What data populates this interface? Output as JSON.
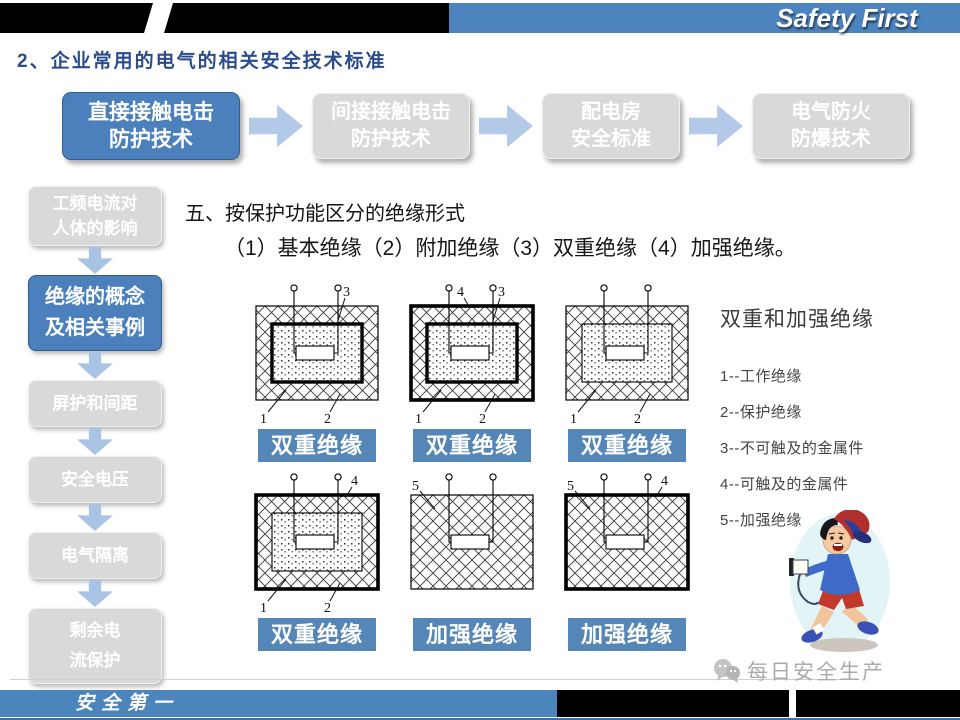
{
  "header": {
    "brand": "Safety First",
    "section_title": "2、企业常用的电气的相关安全技术标准"
  },
  "flow": {
    "boxes": [
      {
        "label": "直接接触电击\n防护技术",
        "active": true
      },
      {
        "label": "间接接触电击\n防护技术",
        "active": false
      },
      {
        "label": "配电房\n安全标准",
        "active": false
      },
      {
        "label": "电气防火\n防爆技术",
        "active": false
      }
    ]
  },
  "sidebar": {
    "items": [
      {
        "label": "工频电流对\n人体的影响",
        "active": false
      },
      {
        "label": "绝缘的概念\n及相关事例",
        "active": true
      },
      {
        "label": "屏护和间距",
        "active": false
      },
      {
        "label": "安全电压",
        "active": false
      },
      {
        "label": "电气隔离",
        "active": false
      },
      {
        "label": "剩余电\n流保护",
        "active": false
      }
    ]
  },
  "main": {
    "heading": "五、按保护功能区分的绝缘形式",
    "subheading": "（1）基本绝缘（2）附加绝缘（3）双重绝缘（4）加强绝缘。"
  },
  "diagrams": [
    {
      "caption": "双重绝缘",
      "outer": "thin",
      "inner": "thick",
      "top_labels": [
        {
          "text": "3",
          "pos": "right-inner"
        }
      ],
      "bottom_labels": [
        "1",
        "2"
      ]
    },
    {
      "caption": "双重绝缘",
      "outer": "thick",
      "inner": "thick",
      "top_labels": [
        {
          "text": "4",
          "pos": "midleft"
        },
        {
          "text": "3",
          "pos": "right-inner"
        }
      ],
      "bottom_labels": [
        "1",
        "2"
      ]
    },
    {
      "caption": "双重绝缘",
      "outer": "thin",
      "inner": "thin",
      "top_labels": [],
      "bottom_labels": [
        "1",
        "2"
      ]
    },
    {
      "caption": "双重绝缘",
      "outer": "thick",
      "inner": "thin",
      "top_labels": [
        {
          "text": "4",
          "pos": "right-outer"
        }
      ],
      "bottom_labels": [
        "1",
        "2"
      ]
    },
    {
      "caption": "加强绝缘",
      "outer": "thin",
      "inner": null,
      "top_labels": [
        {
          "text": "5",
          "pos": "left"
        }
      ],
      "bottom_labels": []
    },
    {
      "caption": "加强绝缘",
      "outer": "thick",
      "inner": null,
      "top_labels": [
        {
          "text": "5",
          "pos": "left"
        },
        {
          "text": "4",
          "pos": "right-outer"
        }
      ],
      "bottom_labels": []
    }
  ],
  "legend": {
    "title": "双重和加强绝缘",
    "items": [
      "1--工作绝缘",
      "2--保护绝缘",
      "3--不可触及的金属件",
      "4--可触及的金属件",
      "5--加强绝缘"
    ]
  },
  "watermark": {
    "text": "每日安全生产"
  },
  "footer": {
    "label": "安全第一"
  },
  "colors": {
    "accent_blue": "#4c84c0",
    "active_box_blue": "#4b80bd",
    "caption_blue": "#5586b8",
    "box_gray": "#d9d9d9",
    "arrow_blue": "#b2c9e8",
    "title_blue": "#2b4c8c"
  }
}
